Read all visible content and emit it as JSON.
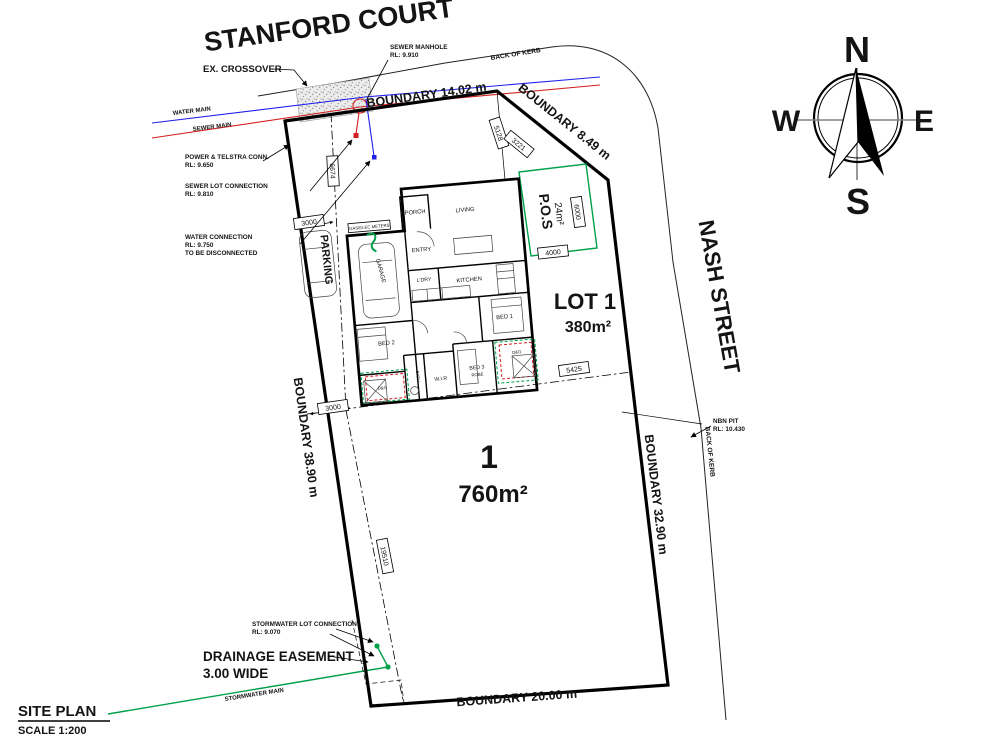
{
  "streets": {
    "stanford_court": "STANFORD COURT",
    "nash_street": "NASH STREET",
    "kerb_top": "BACK OF KERB",
    "kerb_right": "BACK OF KERB"
  },
  "compass": {
    "n": "N",
    "s": "S",
    "e": "E",
    "w": "W"
  },
  "boundaries": {
    "top": "BOUNDARY 14.02 m",
    "ne": "BOUNDARY 8.49 m",
    "right": "BOUNDARY 32.90 m",
    "left": "BOUNDARY 38.90 m",
    "bottom": "BOUNDARY 20.00 m"
  },
  "lots": {
    "lot1": "LOT 1",
    "lot1_area": "380m²",
    "parent_num": "1",
    "parent_area": "760m²",
    "pos": "P.O.S",
    "pos_area": "24m²"
  },
  "rooms": {
    "porch": "PORCH",
    "entry": "ENTRY",
    "living": "LIVING",
    "kitchen": "KITCHEN",
    "laundry": "L'DRY",
    "garage": "GARAGE",
    "bed1": "BED 1",
    "bed2": "BED 2",
    "bed3": "BED 3",
    "bed3_sub": "ROBE",
    "wir": "W.I.R",
    "bath": "BATH",
    "dg_left": "D&G",
    "dg_right": "D&G",
    "meter": "GAS/ELEC METERS",
    "parking": "PARKING"
  },
  "dims": {
    "t3000": "3000",
    "b3000": "3000",
    "d6674": "6674",
    "d5128": "5128",
    "d3221": "3221",
    "d6000": "6000",
    "d4000": "4000",
    "d5425": "5425",
    "d19510": "19510"
  },
  "ann": {
    "ex_crossover": "EX. CROSSOVER",
    "manhole1": "SEWER MANHOLE",
    "manhole2": "RL: 9.910",
    "water_main": "WATER MAIN",
    "sewer_main": "SEWER MAIN",
    "pt1": "POWER & TELSTRA CONN.",
    "pt2": "RL: 9.650",
    "sl1": "SEWER LOT CONNECTION",
    "sl2": "RL: 9.810",
    "wc1": "WATER CONNECTION",
    "wc2": "RL: 9.750",
    "wc3": "TO BE DISCONNECTED",
    "nbn1": "NBN PIT",
    "nbn2": "RL: 10.430",
    "sw1": "STORMWATER LOT CONNECTION",
    "sw2": "RL: 9.070",
    "de1": "DRAINAGE EASEMENT",
    "de2": "3.00 WIDE",
    "swm": "STORMWATER MAIN"
  },
  "footer": {
    "title": "SITE PLAN",
    "scale": "SCALE 1:200"
  },
  "colors": {
    "water_main": "#1f1fee",
    "sewer_main": "#d42020",
    "stormwater": "#00a04a",
    "pos_outline": "#00a04a",
    "line": "#000000",
    "background": "#ffffff"
  }
}
